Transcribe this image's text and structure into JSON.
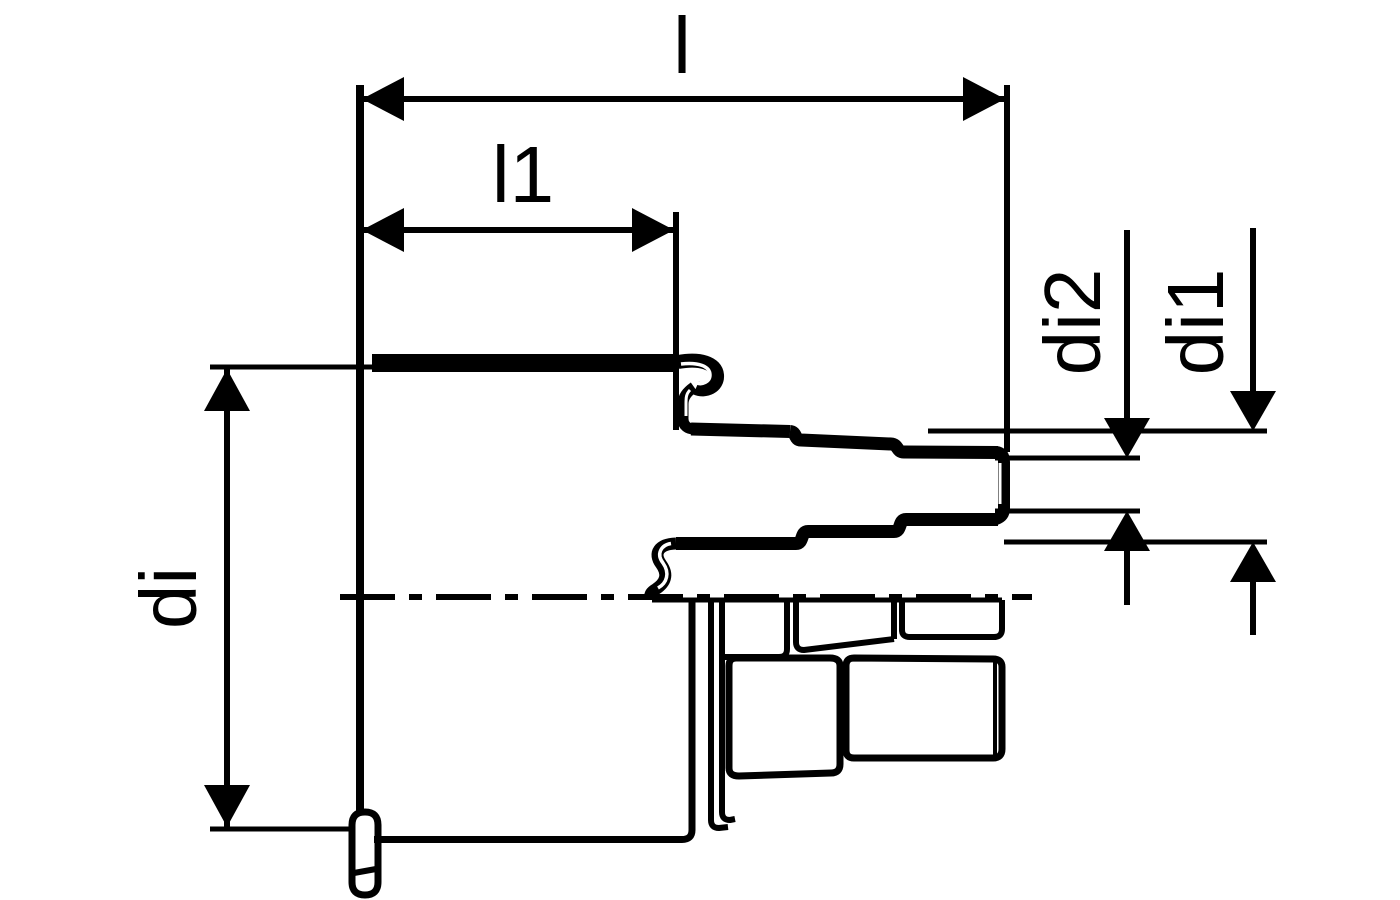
{
  "drawing": {
    "type": "technical-dimension-drawing",
    "subject": "stepped-reducer-fitting-cross-section",
    "background_color": "#ffffff",
    "line_color": "#000000",
    "labels": {
      "l": "l",
      "l1": "l1",
      "di": "di",
      "di2": "di2",
      "di1": "di1"
    }
  }
}
